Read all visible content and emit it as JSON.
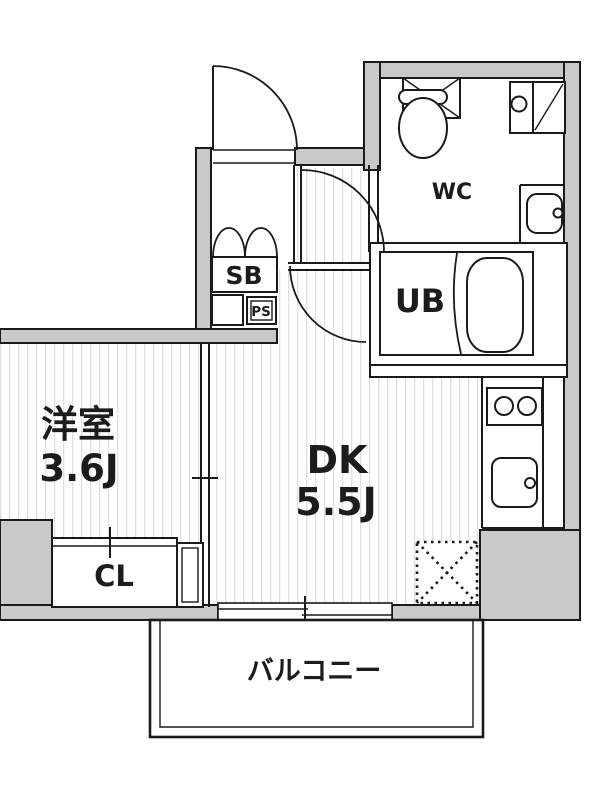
{
  "diagram_type": "apartment-floor-plan",
  "colors": {
    "wall_fill": "#c9c9c9",
    "line": "#1a1a1a",
    "hatch": "#e0e0e0",
    "background": "#ffffff"
  },
  "rooms": {
    "western_room": {
      "name": "洋室",
      "size": "3.6J"
    },
    "dining_kitchen": {
      "name": "DK",
      "size": "5.5J"
    },
    "toilet": {
      "label": "WC"
    },
    "unit_bath": {
      "label": "UB"
    },
    "closet": {
      "label": "CL"
    },
    "shoe_box": {
      "label": "SB"
    },
    "pipe_space": {
      "label": "PS"
    },
    "balcony": {
      "label": "バルコニー"
    }
  }
}
